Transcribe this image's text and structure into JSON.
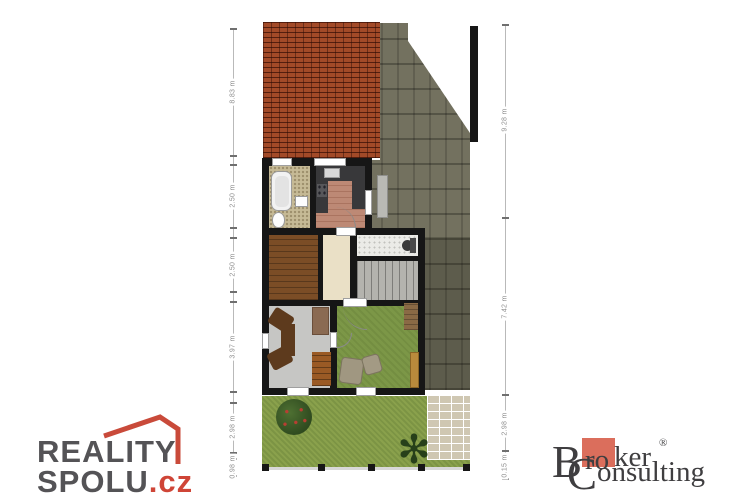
{
  "document": {
    "type": "real-estate floor plan with watermarks"
  },
  "dims": {
    "left": [
      {
        "text": "8.83 m"
      },
      {
        "text": "2.50 m"
      },
      {
        "text": "2.50 m"
      },
      {
        "text": "3.97 m"
      },
      {
        "text": "2.98 m"
      },
      {
        "text": "0.98 m"
      }
    ],
    "right": [
      {
        "text": "9.28 m"
      },
      {
        "text": "7.42 m"
      },
      {
        "text": "2.98 m"
      },
      {
        "text": "0.15 m"
      }
    ]
  },
  "logos": {
    "reality_spolu": {
      "line1": "REALITY",
      "line2": "SPOLU",
      "tld": ".cz"
    },
    "broker": {
      "initial1": "B",
      "boxed": "ro",
      "rest1": "ker",
      "registered": "®",
      "initial2": "C",
      "rest2": "onsulting"
    }
  },
  "icons": {
    "plant_glyph": "✻"
  },
  "palette": {
    "roof": "#a24a28",
    "stone": "#73715f",
    "wall": "#161616",
    "bath_floor": "#c6ba96",
    "kitchen_floor": "#bd8975",
    "counter": "#38383a",
    "wood_floor": "#7b4d26",
    "hall_floor": "#eae0c6",
    "stair": "#b4b3ae",
    "office_floor": "#c6c6c4",
    "living_floor": "#7c9747",
    "lawn": "#8aa14c",
    "patio": "#cfc7b2",
    "dim_text": "#8f8f8f",
    "reality_text": "#545356",
    "reality_red": "#cf4537",
    "broker_text": "#3f3e40",
    "broker_box": "#db6e5c"
  }
}
